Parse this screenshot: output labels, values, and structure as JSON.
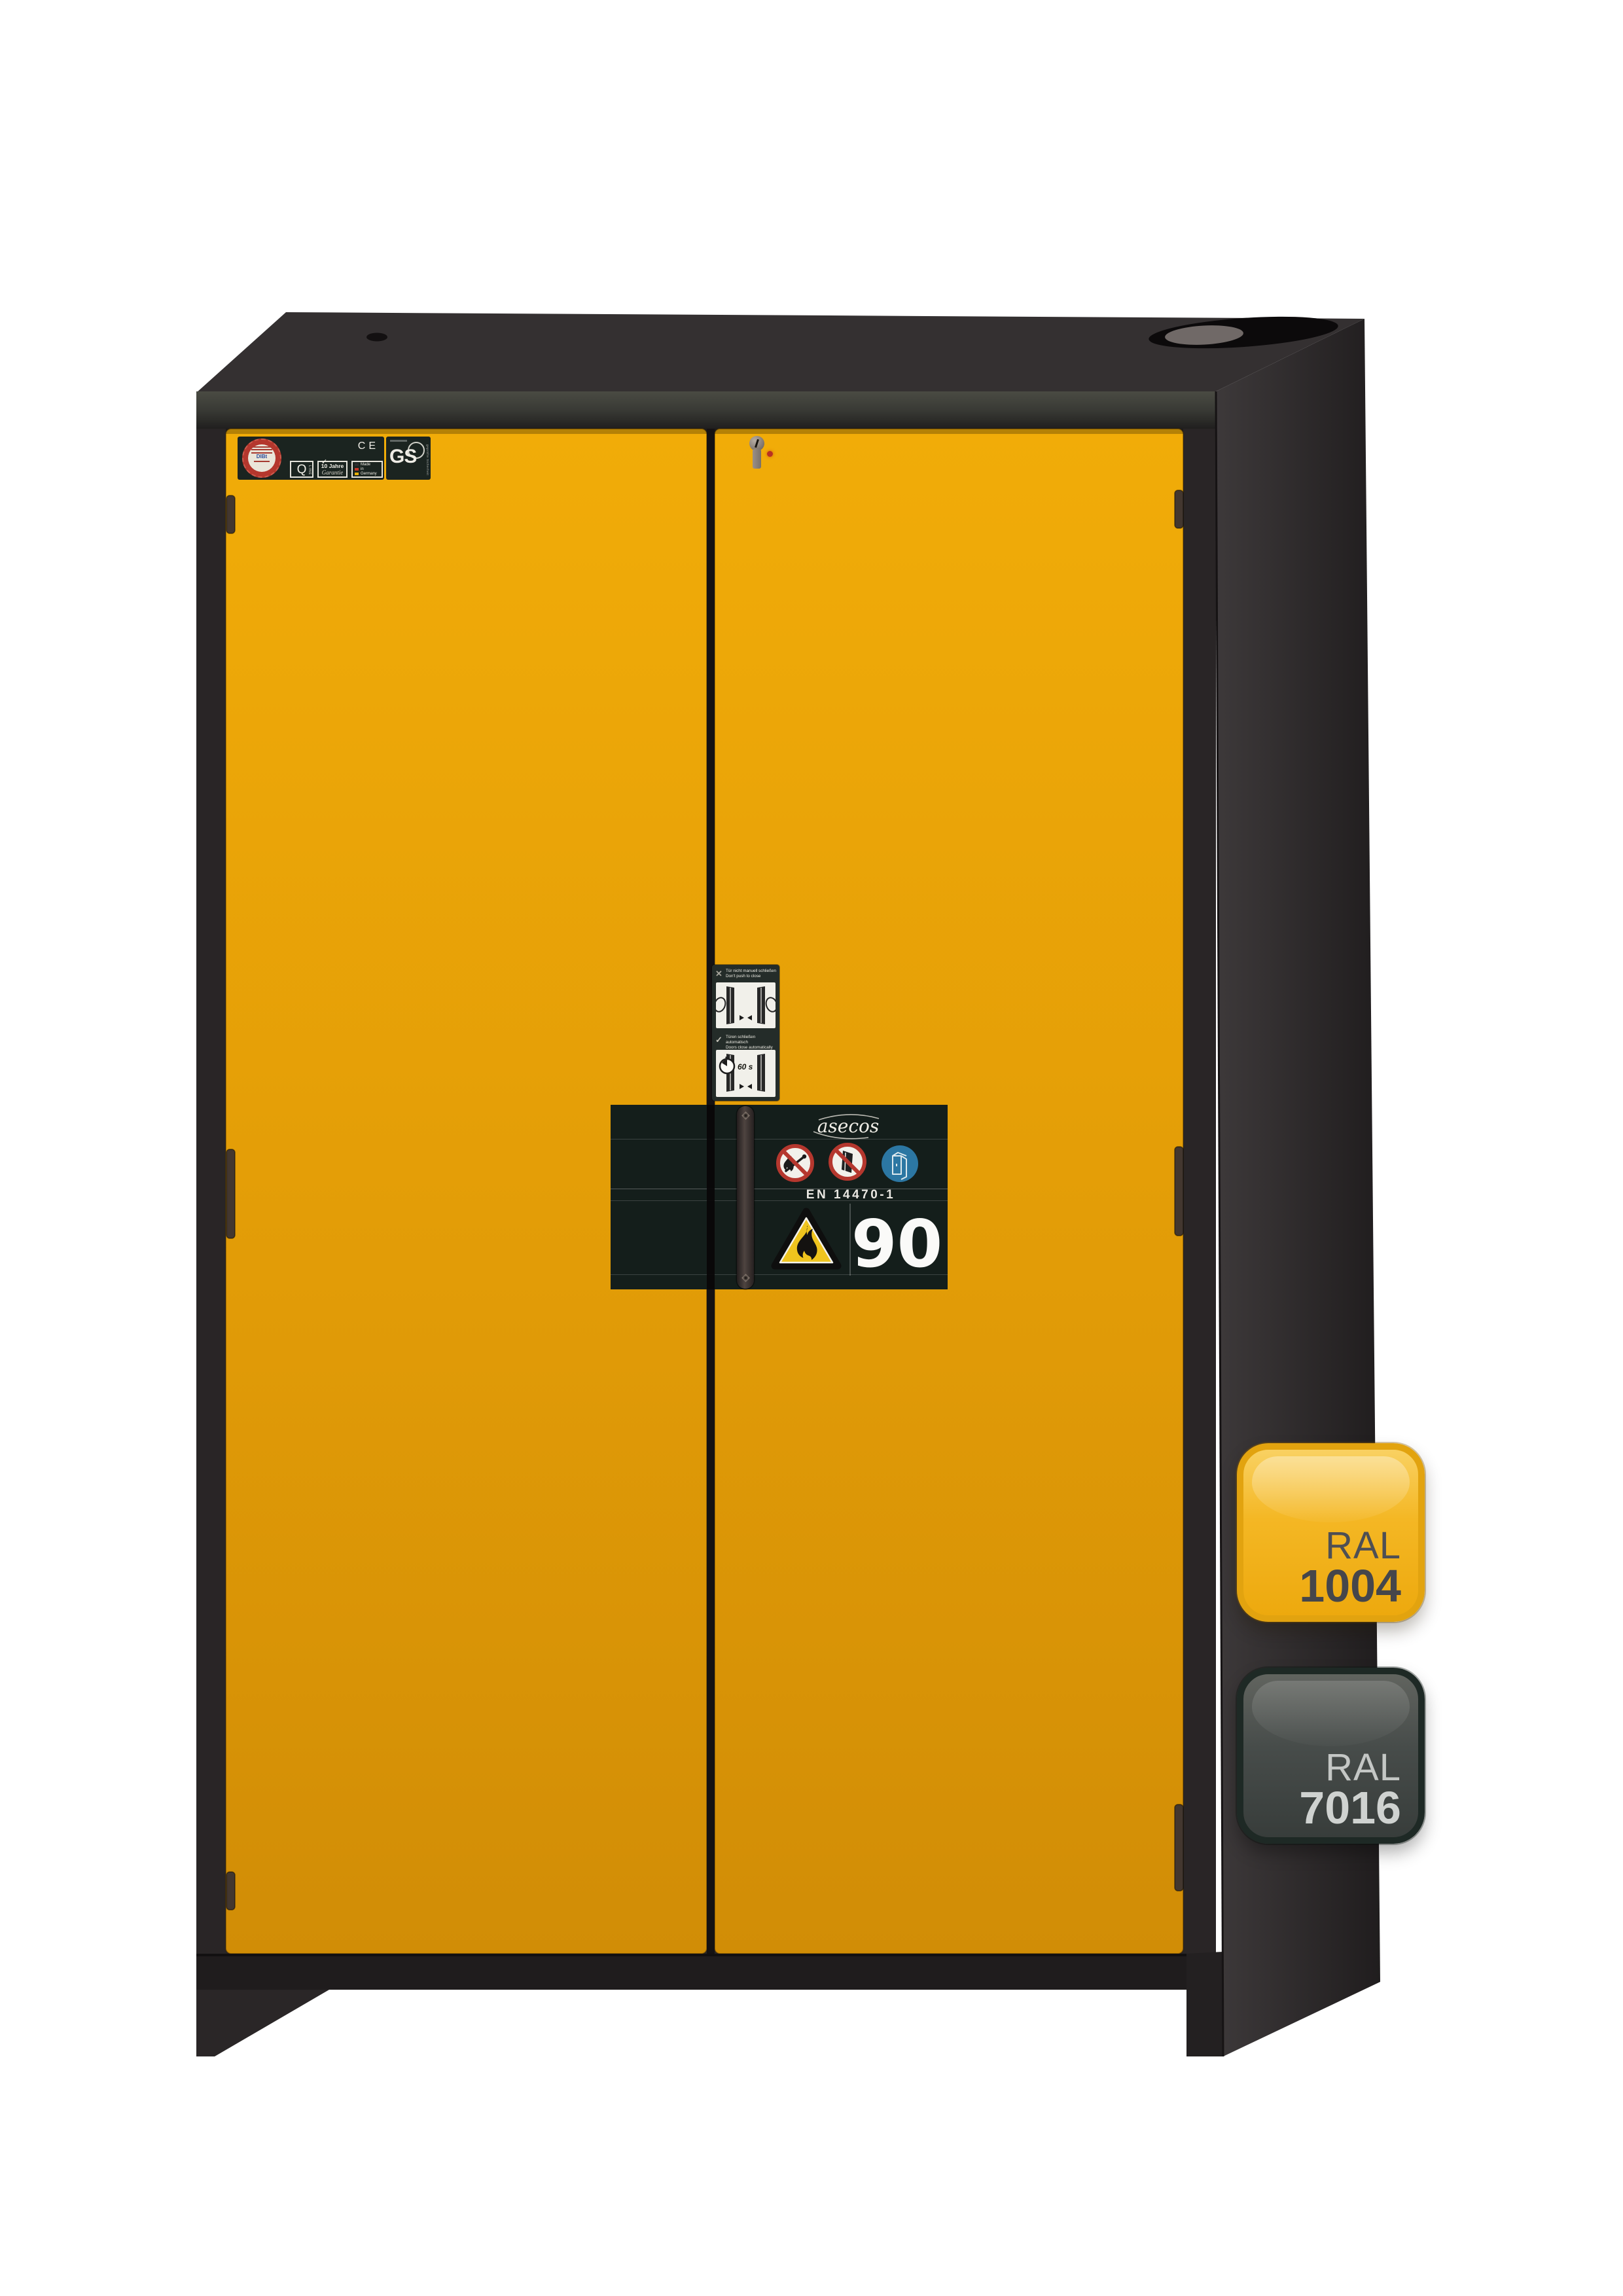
{
  "scene": {
    "background": "#FFFFFF",
    "subject": "fire-resistant safety storage cabinet with closed wing doors"
  },
  "colors": {
    "door_yellow": "#E4A010",
    "body_anthracite": "#3E4346",
    "type_label_background": "#141E1B",
    "prohibition_red": "#B5372E",
    "mandatory_blue": "#2C77A3",
    "warning_yellow": "#EFC41E"
  },
  "type_label": {
    "brand": "asecos",
    "standard": "EN 14470-1",
    "fire_rating": "90"
  },
  "cert": {
    "ce_mark": "CE",
    "q_line": {
      "q": "Q",
      "line": "LINE"
    },
    "warranty": {
      "years": "10 Jahre",
      "word": "Garantie"
    },
    "made_in_germany": {
      "w1": "Made",
      "w2": "in",
      "w3": "Germany"
    },
    "gs_mark": {
      "text": "GS",
      "subtitle": "geprüfte Sicherheit"
    },
    "approval_seal": {
      "authority": "DIBt"
    }
  },
  "auto_close_sticker": {
    "cross_glyph": "✕",
    "check_glyph": "✓",
    "dont_push_de": "Tür nicht manuell schließen",
    "dont_push_en": "Don't push to close",
    "auto_close_de": "Türen schließen automatisch",
    "auto_close_en": "Doors close automatically",
    "close_time": "60 s"
  },
  "swatches": {
    "door_color": {
      "label": "RAL",
      "code": "1004",
      "hex": "#E4A010"
    },
    "body_color": {
      "label": "RAL",
      "code": "7016",
      "hex": "#383E42"
    }
  }
}
